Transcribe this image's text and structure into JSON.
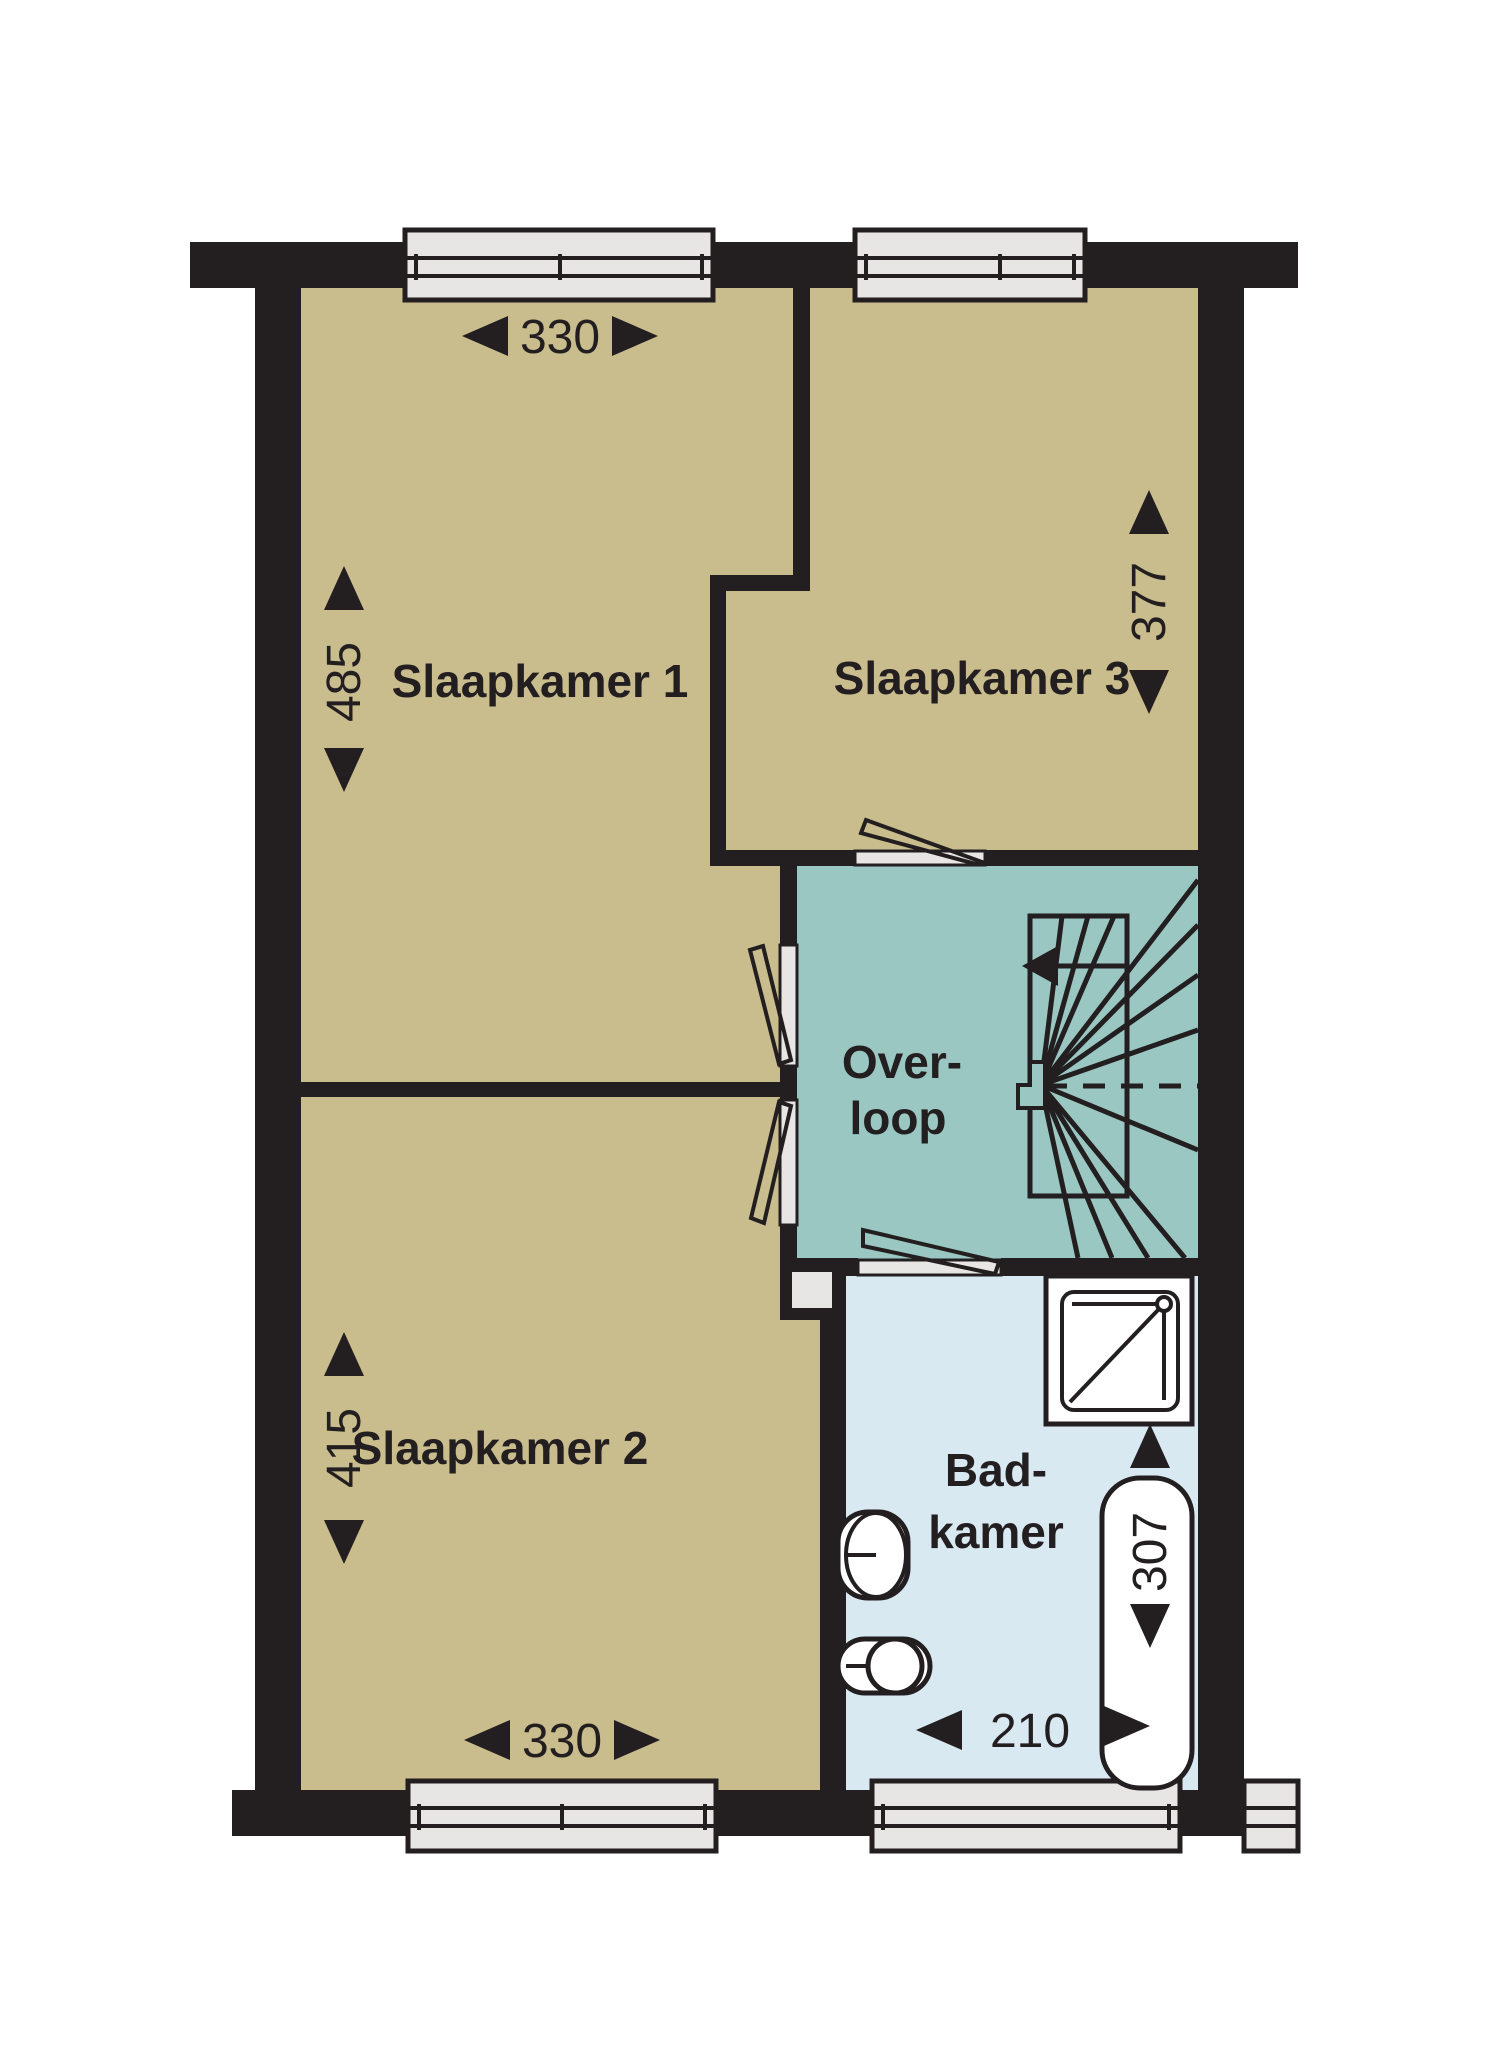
{
  "floorplan": {
    "rooms": {
      "slaapkamer1": {
        "name": "Slaapkamer 1",
        "width_cm": "330",
        "depth_cm": "485"
      },
      "slaapkamer3": {
        "name": "Slaapkamer 3",
        "depth_cm": "377"
      },
      "slaapkamer2": {
        "name": "Slaapkamer 2",
        "width_cm": "330",
        "depth_cm": "415"
      },
      "overloop": {
        "name_line1": "Over-",
        "name_line2": "loop"
      },
      "badkamer": {
        "name_line1": "Bad-",
        "name_line2": "kamer",
        "width_cm": "210",
        "depth_cm": "307"
      }
    },
    "colors": {
      "wall": "#231f20",
      "bedroom_floor": "#c9bc8d",
      "landing_floor": "#9ac7c2",
      "bathroom_floor": "#d9e9f2",
      "window_fill": "#e8e6e5",
      "background": "#ffffff"
    },
    "fixtures": [
      "stairs",
      "shower",
      "bathtub",
      "sink",
      "toilet",
      "shaft"
    ]
  }
}
